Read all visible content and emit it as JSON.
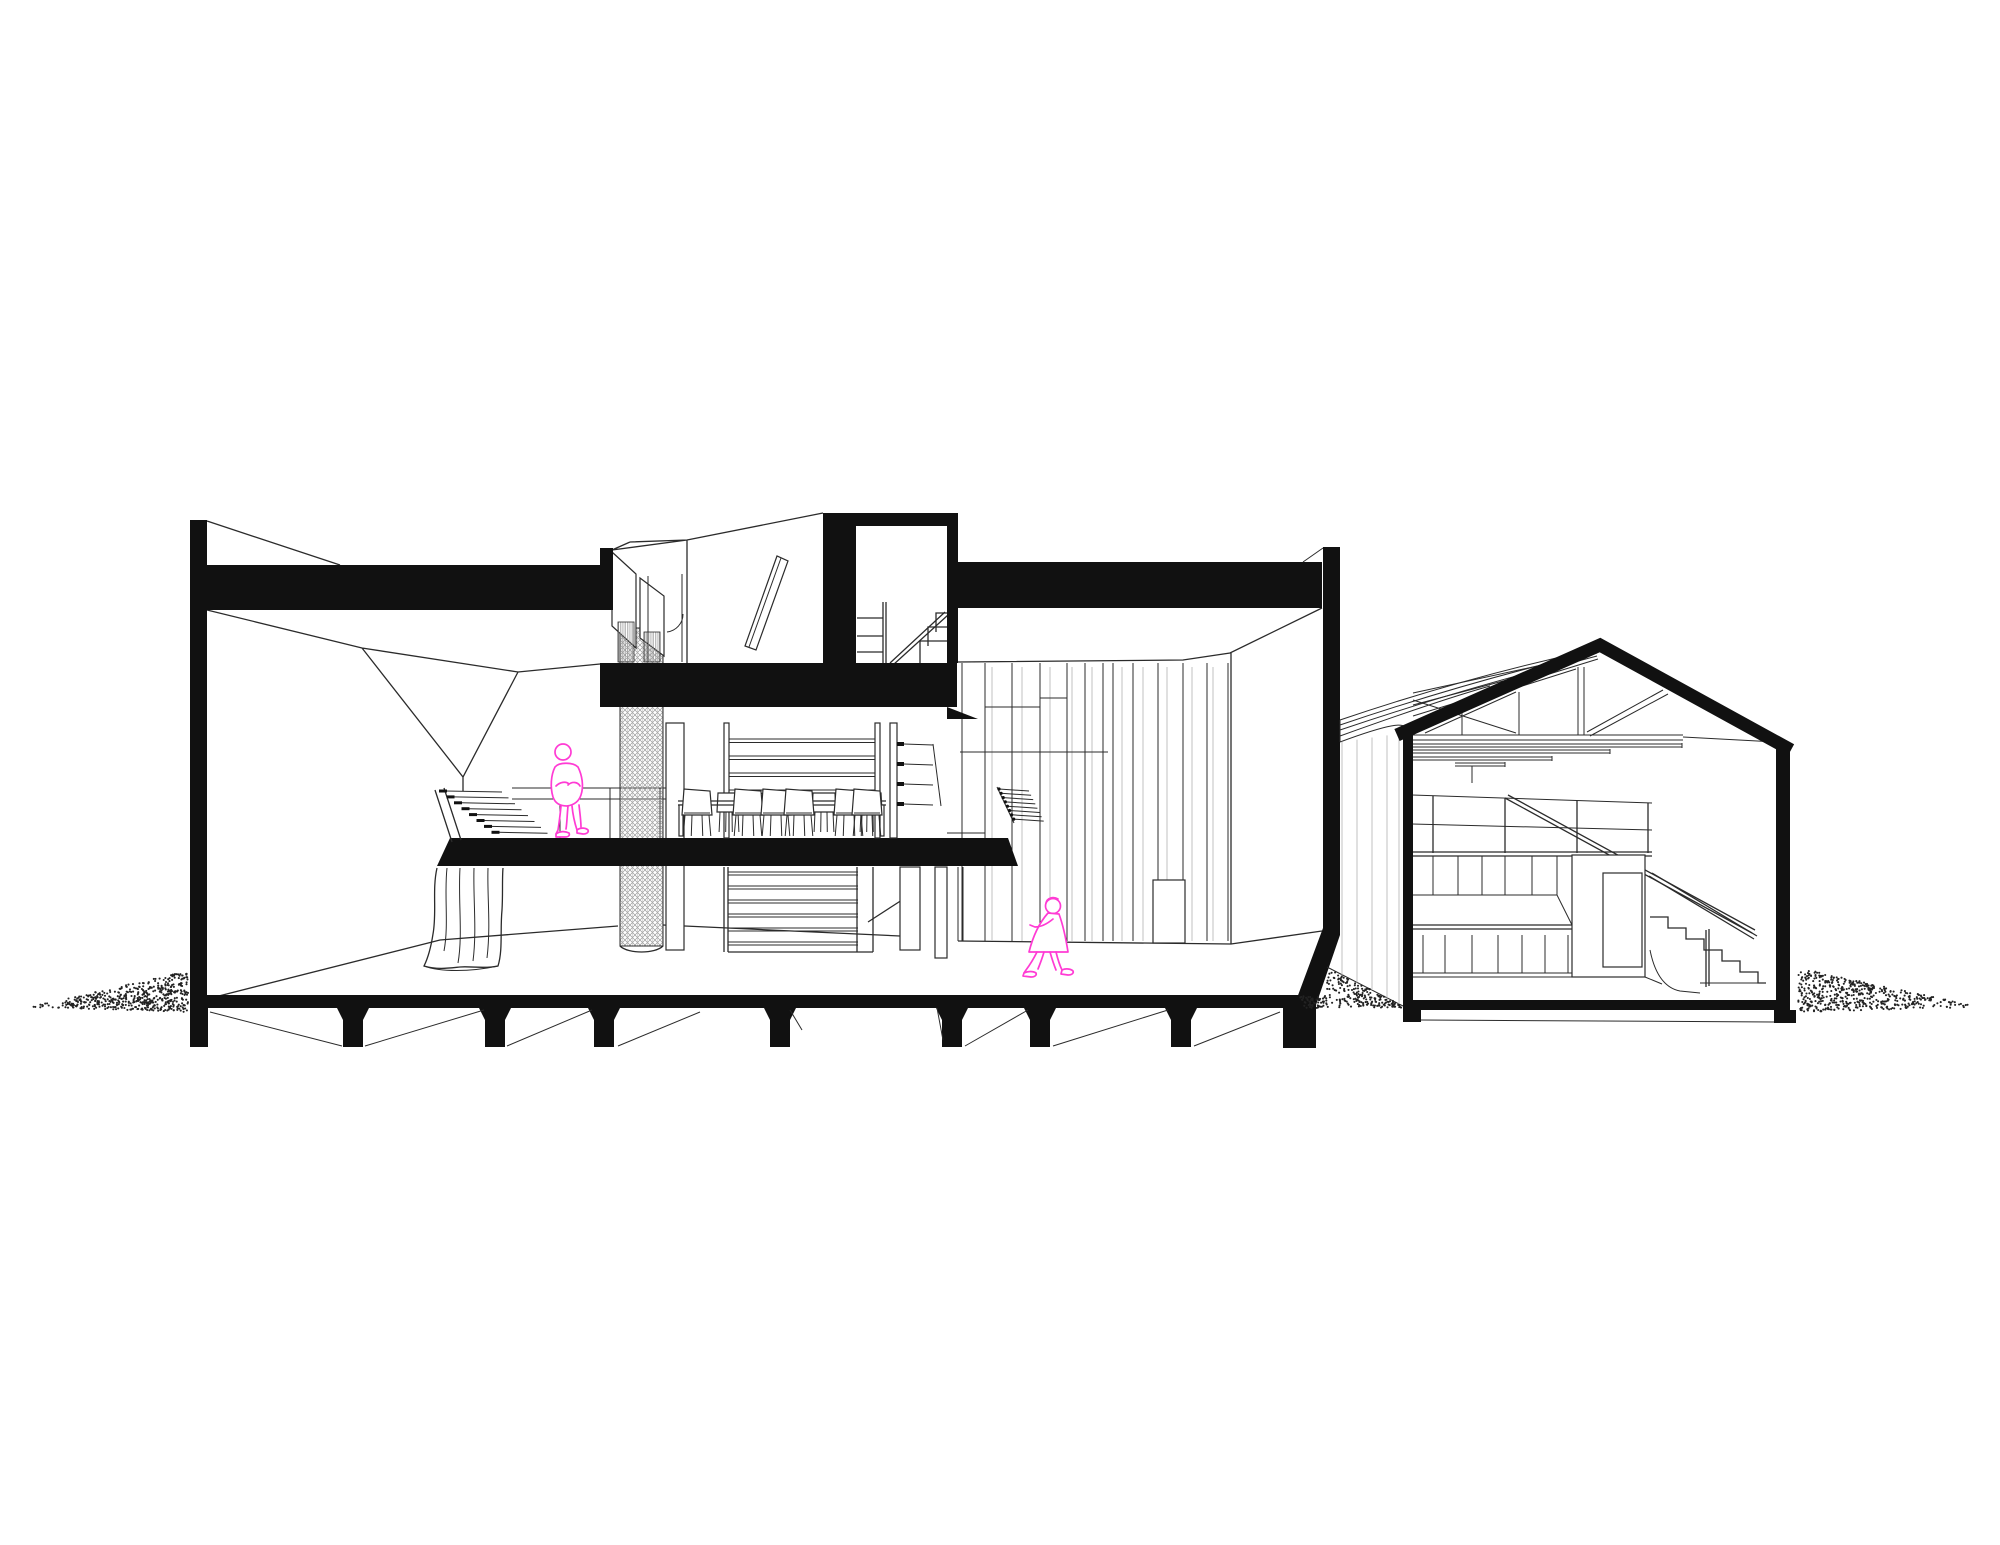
{
  "meta": {
    "title": "Architectural section drawing",
    "description": "Black-and-white building cross section with two magenta figures and stippled ground"
  },
  "colors": {
    "ink": "#111111",
    "line": "#2b2b2b",
    "light": "#c2c2c2",
    "hatch": "#9a9a9a",
    "pink": "#ff3bd4",
    "paper": "#ffffff"
  },
  "foundation": {
    "pier_centers": [
      353,
      495,
      604,
      780,
      952,
      1040,
      1181
    ],
    "pier_top": 1008,
    "pier_bottom": 1047,
    "bay_diagonals": [
      [
        210,
        1012,
        342,
        1046
      ],
      [
        365,
        1046,
        484,
        1010
      ],
      [
        507,
        1046,
        592,
        1010
      ],
      [
        618,
        1046,
        700,
        1012
      ],
      [
        790,
        1010,
        802,
        1030
      ],
      [
        937,
        1008,
        943,
        1040
      ],
      [
        965,
        1046,
        1028,
        1010
      ],
      [
        1053,
        1046,
        1168,
        1010
      ],
      [
        1194,
        1046,
        1280,
        1012
      ]
    ]
  },
  "paneling": {
    "dark_x": [
      962,
      985,
      1012,
      1040,
      1067,
      1085,
      1103,
      1113,
      1133,
      1158,
      1183,
      1207,
      1228
    ],
    "light_x": [
      992,
      1022,
      1050,
      1072,
      1092,
      1122,
      1143,
      1167,
      1192,
      1213
    ],
    "top_y": 663,
    "bottom_y": 941,
    "joints": [
      [
        985,
        707,
        1040
      ],
      [
        960,
        752,
        1108
      ],
      [
        1040,
        698,
        1067
      ],
      [
        947,
        833,
        985
      ]
    ],
    "door": [
      1153,
      880,
      32,
      63
    ]
  },
  "left_stair": {
    "treads": 8,
    "x0": 446,
    "y0": 791,
    "dx": 7.5,
    "dy": 5.9,
    "len": 56
  },
  "shelf": {
    "rail_y": [
      739,
      756,
      773,
      790
    ],
    "bracket_y": [
      744,
      764,
      784,
      804
    ]
  },
  "ticks": {
    "count": 8,
    "x0": 999,
    "y0": 789,
    "dx": 2.1,
    "dy": 4.3,
    "len": 30
  },
  "table": {
    "x1": 678,
    "x2": 886,
    "y": 801
  },
  "chairs": {
    "near_x": [
      697,
      748,
      776,
      799,
      849,
      867
    ],
    "far_x": [
      729,
      824,
      870
    ]
  },
  "big_stair": {
    "treads_y": [
      872,
      886,
      900,
      914,
      928,
      942
    ],
    "x1": 728,
    "x2": 858
  },
  "gable": {
    "siding_x": [
      1342,
      1357,
      1372,
      1387,
      1399
    ],
    "rail_posts": [
      1433,
      1505,
      1577,
      1648
    ],
    "cab_upper_x": [
      1433,
      1458,
      1482,
      1505,
      1532,
      1557
    ],
    "cab_lower_x": [
      1423,
      1445,
      1472,
      1498,
      1522,
      1545,
      1568
    ],
    "purlins": [
      [
        1413,
        744,
        1682
      ],
      [
        1413,
        750,
        1610
      ],
      [
        1413,
        757,
        1552
      ],
      [
        1455,
        763,
        1505
      ]
    ]
  },
  "stipple": {
    "left": {
      "tip_x": 30,
      "base_x": 188,
      "base_top": 971,
      "base_bot": 1012,
      "n": 520
    },
    "right": {
      "tip_x": 1980,
      "base_x": 1798,
      "base_top": 968,
      "base_bot": 1012,
      "n": 520
    },
    "mid": {
      "x1": 1300,
      "x2": 1402,
      "bot": 1008,
      "n": 260
    }
  },
  "people": {
    "standing": {
      "head": {
        "cx": 563,
        "cy": 752,
        "r": 8
      },
      "body": "M555,767 C559,762 573,762 578,767 C582,775 584,786 581,795 C579,801 574,805 567,806 C560,806 555,803 553,797 C550,787 551,775 555,767 Z",
      "arms": "M556,786 C560,782 566,781 569,784 M568,785 C572,781 578,782 580,786",
      "legs": "M561,806 C560,816 559,824 558,830 L556,834 M568,806 C567,816 567,823 566,829 M572,806 C573,816 575,824 577,830 M579,805 C580,814 581,821 581,827",
      "feet": "M556,834 C560,831 565,831 569,833 C570,835 569,837 565,837 L556,837 Z M577,830 C581,827 586,828 588,830 C589,832 587,834 583,834 L577,833 Z"
    },
    "walking": {
      "head": {
        "cx": 1053,
        "cy": 906,
        "r": 7.5
      },
      "hair": "M1046,903 C1047,898 1053,896 1058,899",
      "body": "M1048,913 L1059,914 C1063,925 1066,939 1068,952 L1029,952 C1033,936 1040,922 1048,913 Z",
      "arm": "M1053,919 C1047,924 1041,927 1035,927 L1030,925",
      "legs": "M1037,952 C1033,960 1029,966 1026,970 L1024,973 M1044,952 C1042,959 1040,964 1038,969 M1056,952 C1058,960 1060,966 1062,970 M1050,952 C1052,959 1054,965 1056,970",
      "feet": "M1024,973 C1028,971 1033,971 1036,973 C1037,975 1035,977 1031,977 L1023,976 Z M1062,970 C1066,968 1071,969 1073,971 C1074,973 1072,975 1068,975 L1061,974 Z"
    }
  }
}
